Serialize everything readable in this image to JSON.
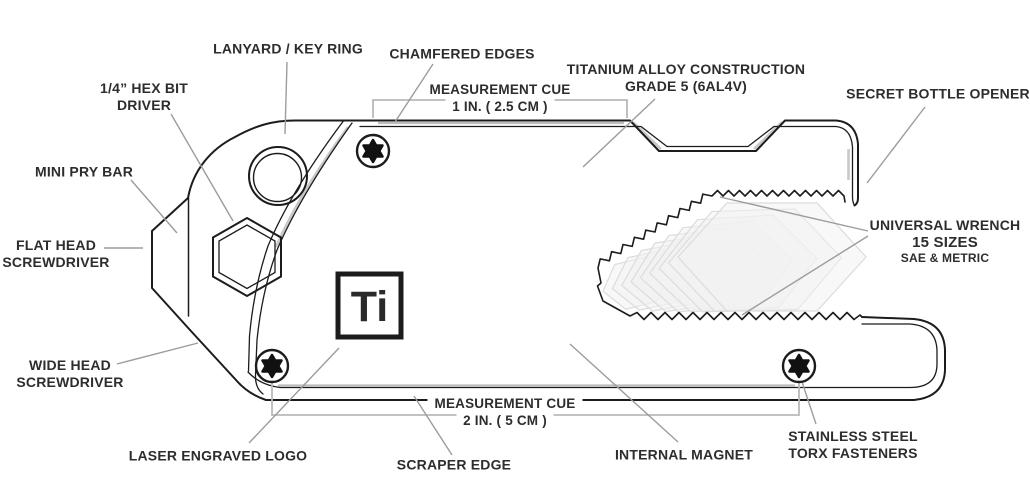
{
  "canvas": {
    "width": 1030,
    "height": 499,
    "background": "#ffffff"
  },
  "colors": {
    "label_text": "#2d2d2d",
    "outline": "#1c1c1c",
    "leader_line": "#9c9c9c",
    "measure_bracket": "#b9b9b9",
    "chamfer_shade": "#c8c8c8",
    "wrench_fill": "#f2f2f2",
    "wrench_stroke": "#dcdcdc"
  },
  "logo": {
    "text": "Ti"
  },
  "callouts": {
    "lanyard": {
      "text": "LANYARD / KEY RING"
    },
    "hex_bit": {
      "line1": "1/4” HEX BIT",
      "line2": "DRIVER"
    },
    "chamfered": {
      "text": "CHAMFERED EDGES"
    },
    "measure_top": {
      "line1": "MEASUREMENT CUE",
      "line2": "1 IN. ( 2.5 CM )"
    },
    "titanium": {
      "line1": "TITANIUM ALLOY CONSTRUCTION",
      "line2": "GRADE 5 (6AL4V)"
    },
    "bottle_opener": {
      "text": "SECRET BOTTLE OPENER"
    },
    "universal_wrench": {
      "line1": "UNIVERSAL WRENCH",
      "line2": "15 SIZES",
      "line3": "SAE & METRIC"
    },
    "mini_pry_bar": {
      "text": "MINI PRY BAR"
    },
    "flat_head": {
      "line1": "FLAT HEAD",
      "line2": "SCREWDRIVER"
    },
    "wide_head": {
      "line1": "WIDE HEAD",
      "line2": "SCREWDRIVER"
    },
    "laser_logo": {
      "text": "LASER ENGRAVED LOGO"
    },
    "scraper_edge": {
      "text": "SCRAPER EDGE"
    },
    "measure_bottom": {
      "line1": "MEASUREMENT CUE",
      "line2": "2 IN. ( 5 CM )"
    },
    "internal_magnet": {
      "text": "INTERNAL MAGNET"
    },
    "torx_fasteners": {
      "line1": "STAINLESS STEEL",
      "line2": "TORX FASTENERS"
    }
  }
}
